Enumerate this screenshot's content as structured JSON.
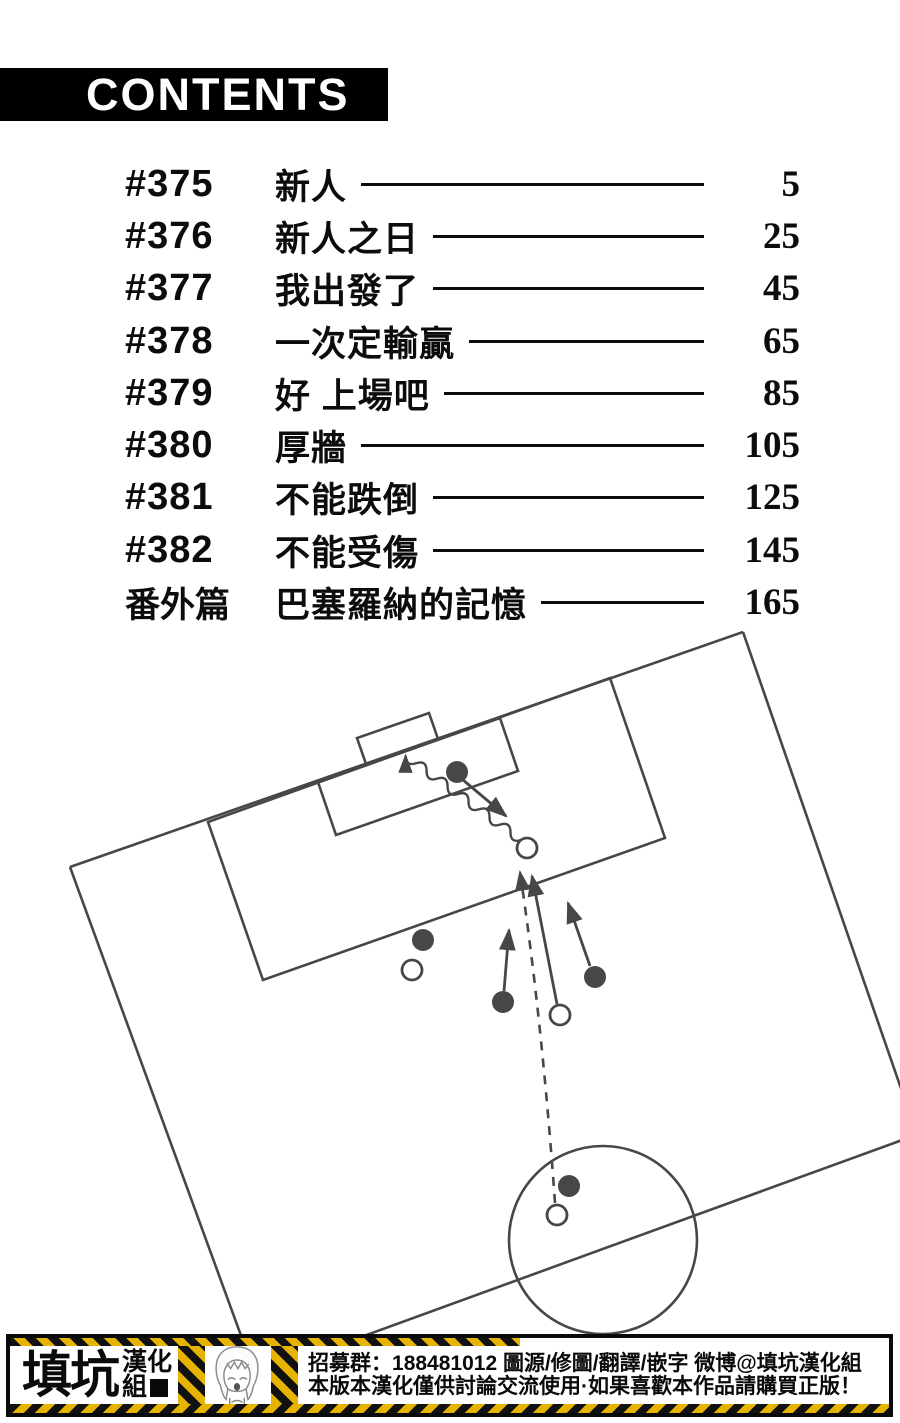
{
  "header": {
    "title": "CONTENTS",
    "bar_color": "#000000",
    "text_color": "#ffffff"
  },
  "toc": {
    "rows": [
      {
        "no": "#375",
        "title": "新人",
        "page": "5"
      },
      {
        "no": "#376",
        "title": "新人之日",
        "page": "25"
      },
      {
        "no": "#377",
        "title": "我出發了",
        "page": "45"
      },
      {
        "no": "#378",
        "title": "一次定輸贏",
        "page": "65"
      },
      {
        "no": "#379",
        "title": "好 上場吧",
        "page": "85"
      },
      {
        "no": "#380",
        "title": "厚牆",
        "page": "105"
      },
      {
        "no": "#381",
        "title": "不能跌倒",
        "page": "125"
      },
      {
        "no": "#382",
        "title": "不能受傷",
        "page": "145"
      },
      {
        "no": "番外篇",
        "title": "巴塞羅納的記憶",
        "page": "165"
      }
    ]
  },
  "diagram": {
    "kind": "soccer-tactics-diagram",
    "stroke": "#474747",
    "field": {
      "lines": [
        [
          70,
          867,
          743,
          632
        ],
        [
          70,
          867,
          243,
          1341
        ],
        [
          743,
          632,
          905,
          1100
        ],
        [
          350,
          1341,
          905,
          1139
        ]
      ],
      "polygons": [
        [
          [
            208,
            822
          ],
          [
            610,
            678
          ],
          [
            665,
            838
          ],
          [
            263,
            980
          ]
        ],
        [
          [
            318,
            782
          ],
          [
            500,
            718
          ],
          [
            518,
            771
          ],
          [
            336,
            835
          ]
        ],
        [
          [
            366,
            764
          ],
          [
            438,
            739
          ],
          [
            429,
            713
          ],
          [
            357,
            738
          ]
        ]
      ],
      "circles": [
        {
          "cx": 603,
          "cy": 1240,
          "r": 94
        }
      ]
    },
    "players": {
      "black": [
        [
          457,
          772
        ],
        [
          423,
          940
        ],
        [
          503,
          1002
        ],
        [
          595,
          977
        ],
        [
          569,
          1186
        ]
      ],
      "white": [
        [
          412,
          970
        ],
        [
          527,
          848
        ],
        [
          560,
          1015
        ],
        [
          557,
          1215
        ]
      ]
    },
    "arrows": [
      {
        "type": "wavy",
        "from": [
          521,
          840
        ],
        "to": [
          398,
          750
        ]
      },
      {
        "type": "solid",
        "from": [
          463,
          780
        ],
        "to": [
          506,
          816
        ]
      },
      {
        "type": "dashed",
        "from": [
          555,
          1203
        ],
        "to": [
          520,
          872
        ],
        "via": [
          542,
          1020
        ]
      },
      {
        "type": "solid",
        "from": [
          557,
          1004
        ],
        "to": [
          532,
          876
        ]
      },
      {
        "type": "solid",
        "from": [
          504,
          991
        ],
        "to": [
          509,
          930
        ]
      },
      {
        "type": "solid",
        "from": [
          590,
          966
        ],
        "to": [
          568,
          903
        ]
      }
    ]
  },
  "footer": {
    "group_name_main": "填坑",
    "group_name_sub1": "漢化",
    "group_name_sub2": "組",
    "line1": "招募群：188481012 圖源/修圖/翻譯/嵌字 微博@填坑漢化組",
    "line2": "本版本漢化僅供討論交流使用·如果喜歡本作品請購買正版！",
    "hazard_yellow": "#e6b400",
    "hazard_black": "#111111"
  }
}
